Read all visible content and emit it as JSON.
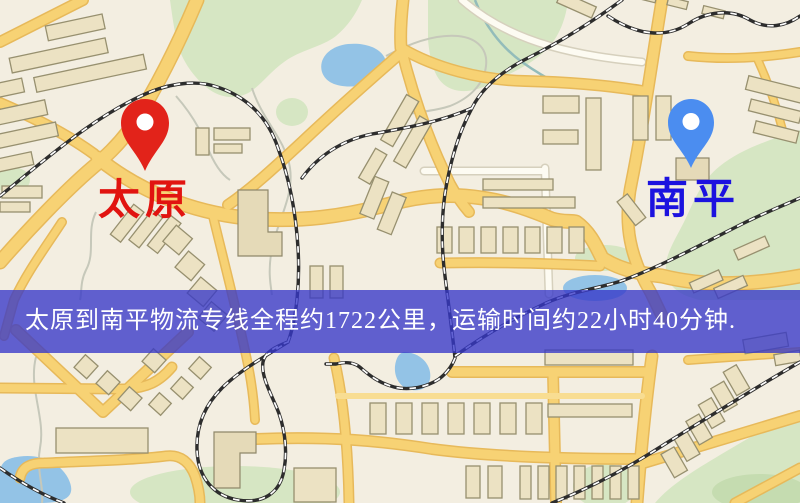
{
  "map": {
    "markers": {
      "origin": {
        "label": "太原",
        "pin_color": "#e2231a",
        "label_color": "#e11410"
      },
      "destination": {
        "label": "南平",
        "pin_color": "#4b8df0",
        "label_color": "#1c12df"
      }
    },
    "banner": {
      "text": "太原到南平物流专线全程约1722公里，运输时间约22小时40分钟.",
      "distance_km": "1722",
      "duration": "22小时40分钟",
      "background": "#3637c8",
      "text_color": "#ffffff"
    }
  },
  "palette": {
    "map_background": "#f3eee1",
    "road_yellow": "#f7d274",
    "road_casing": "#e7b95a",
    "railway": "#2d2d2d",
    "water": "#93c3e6",
    "green_area": "#d6e6c3",
    "building": "#ece2c3"
  }
}
